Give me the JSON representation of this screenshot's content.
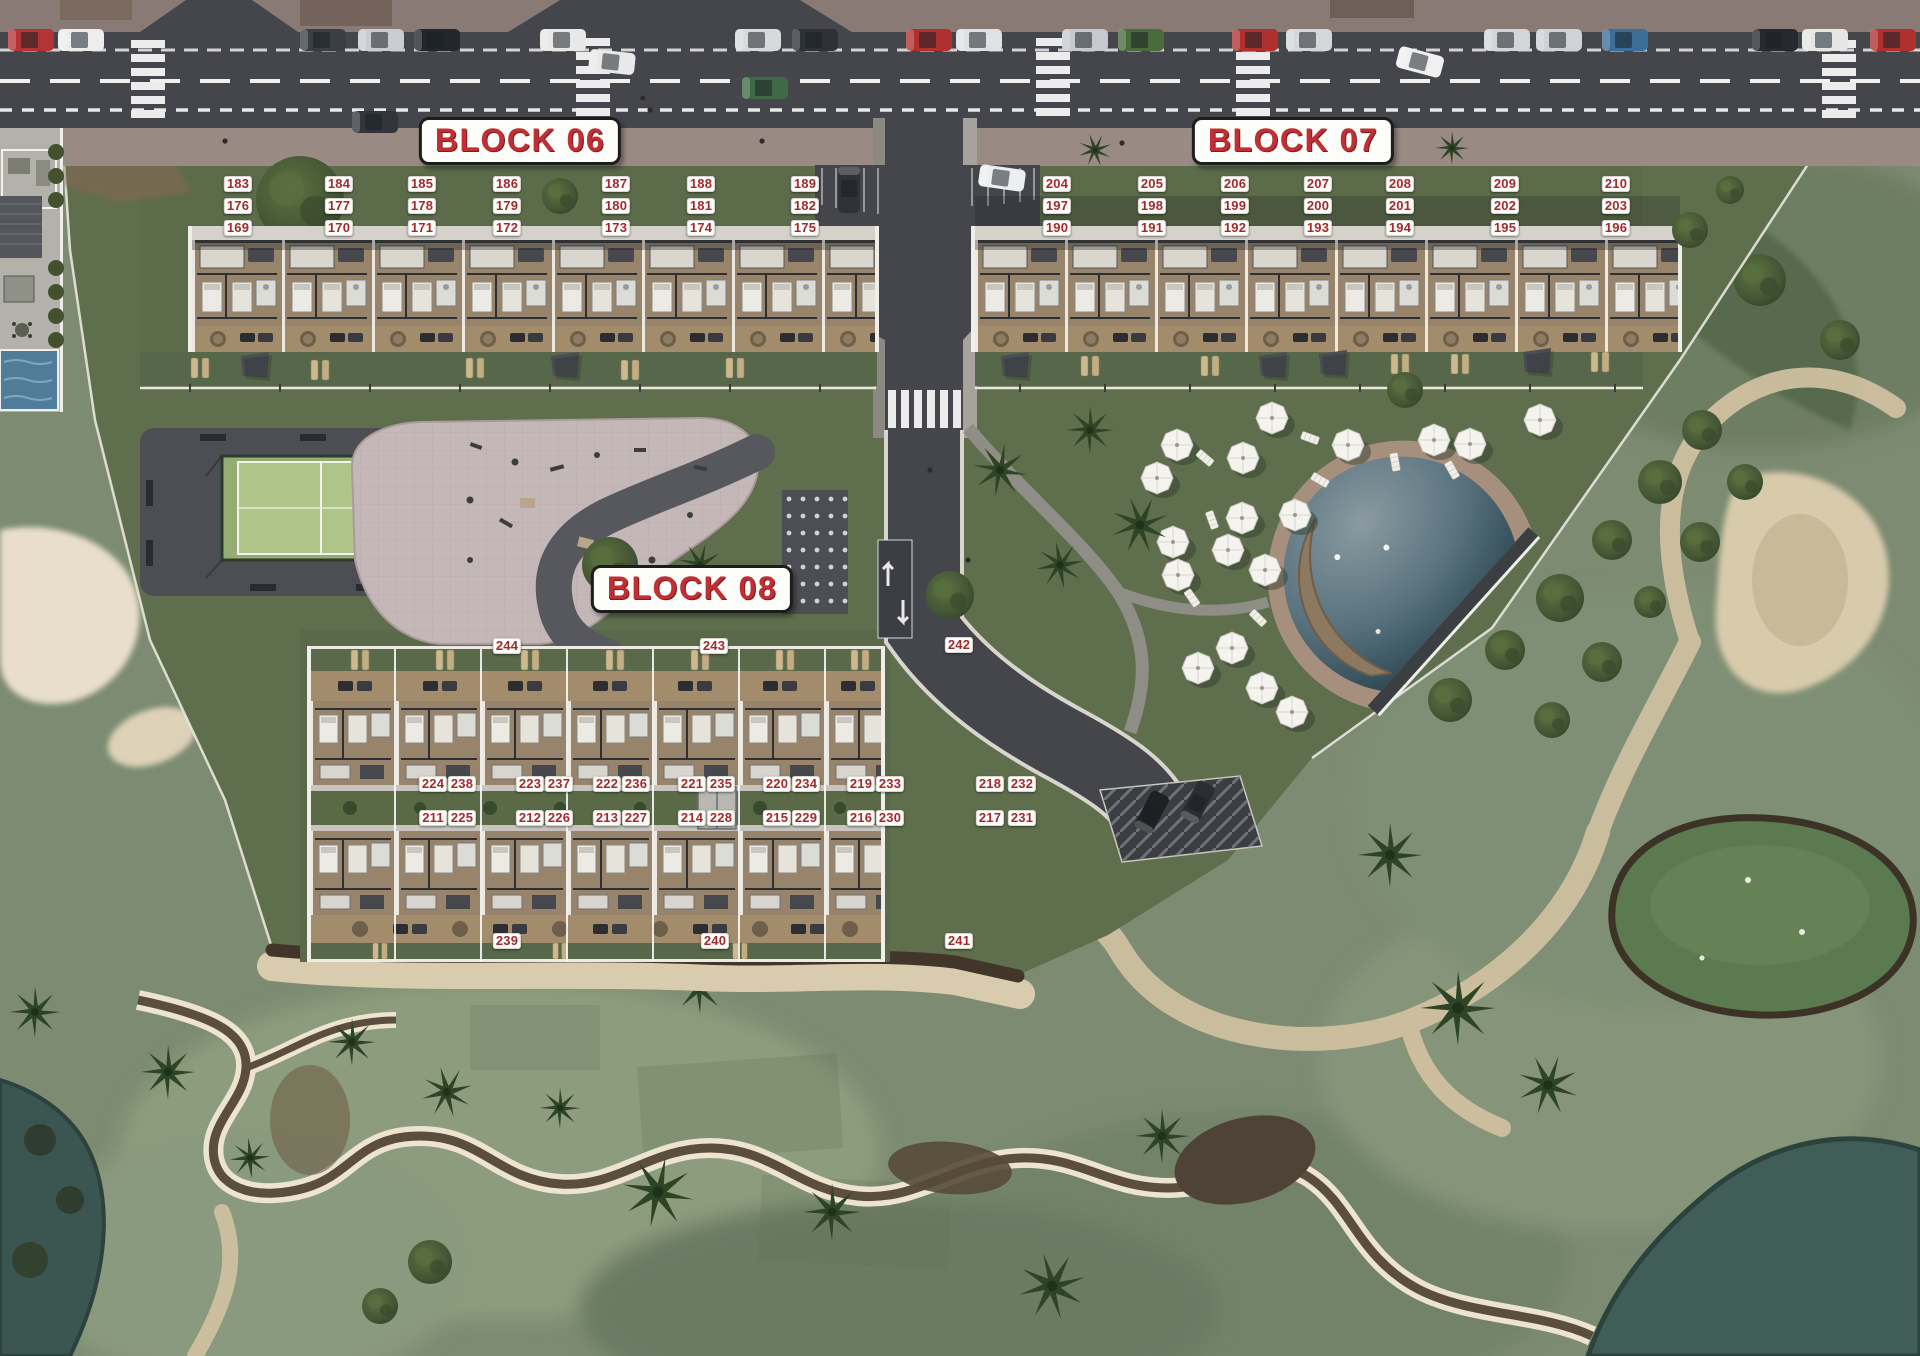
{
  "map": {
    "title_blocks": [
      {
        "id": "06",
        "label": "BLOCK 06",
        "x": 520,
        "y": 141
      },
      {
        "id": "07",
        "label": "BLOCK 07",
        "x": 1293,
        "y": 141
      },
      {
        "id": "08",
        "label": "BLOCK 08",
        "x": 692,
        "y": 589
      }
    ],
    "units": [
      {
        "n": "183",
        "x": 238,
        "y": 184
      },
      {
        "n": "184",
        "x": 339,
        "y": 184
      },
      {
        "n": "185",
        "x": 422,
        "y": 184
      },
      {
        "n": "186",
        "x": 507,
        "y": 184
      },
      {
        "n": "187",
        "x": 616,
        "y": 184
      },
      {
        "n": "188",
        "x": 701,
        "y": 184
      },
      {
        "n": "189",
        "x": 805,
        "y": 184
      },
      {
        "n": "176",
        "x": 238,
        "y": 206
      },
      {
        "n": "177",
        "x": 339,
        "y": 206
      },
      {
        "n": "178",
        "x": 422,
        "y": 206
      },
      {
        "n": "179",
        "x": 507,
        "y": 206
      },
      {
        "n": "180",
        "x": 616,
        "y": 206
      },
      {
        "n": "181",
        "x": 701,
        "y": 206
      },
      {
        "n": "182",
        "x": 805,
        "y": 206
      },
      {
        "n": "169",
        "x": 238,
        "y": 228
      },
      {
        "n": "170",
        "x": 339,
        "y": 228
      },
      {
        "n": "171",
        "x": 422,
        "y": 228
      },
      {
        "n": "172",
        "x": 507,
        "y": 228
      },
      {
        "n": "173",
        "x": 616,
        "y": 228
      },
      {
        "n": "174",
        "x": 701,
        "y": 228
      },
      {
        "n": "175",
        "x": 805,
        "y": 228
      },
      {
        "n": "204",
        "x": 1057,
        "y": 184
      },
      {
        "n": "205",
        "x": 1152,
        "y": 184
      },
      {
        "n": "206",
        "x": 1235,
        "y": 184
      },
      {
        "n": "207",
        "x": 1318,
        "y": 184
      },
      {
        "n": "208",
        "x": 1400,
        "y": 184
      },
      {
        "n": "209",
        "x": 1505,
        "y": 184
      },
      {
        "n": "210",
        "x": 1616,
        "y": 184
      },
      {
        "n": "197",
        "x": 1057,
        "y": 206
      },
      {
        "n": "198",
        "x": 1152,
        "y": 206
      },
      {
        "n": "199",
        "x": 1235,
        "y": 206
      },
      {
        "n": "200",
        "x": 1318,
        "y": 206
      },
      {
        "n": "201",
        "x": 1400,
        "y": 206
      },
      {
        "n": "202",
        "x": 1505,
        "y": 206
      },
      {
        "n": "203",
        "x": 1616,
        "y": 206
      },
      {
        "n": "190",
        "x": 1057,
        "y": 228
      },
      {
        "n": "191",
        "x": 1152,
        "y": 228
      },
      {
        "n": "192",
        "x": 1235,
        "y": 228
      },
      {
        "n": "193",
        "x": 1318,
        "y": 228
      },
      {
        "n": "194",
        "x": 1400,
        "y": 228
      },
      {
        "n": "195",
        "x": 1505,
        "y": 228
      },
      {
        "n": "196",
        "x": 1616,
        "y": 228
      },
      {
        "n": "244",
        "x": 507,
        "y": 646
      },
      {
        "n": "243",
        "x": 714,
        "y": 646
      },
      {
        "n": "242",
        "x": 959,
        "y": 645
      },
      {
        "n": "224",
        "x": 433,
        "y": 784
      },
      {
        "n": "238",
        "x": 462,
        "y": 784
      },
      {
        "n": "223",
        "x": 530,
        "y": 784
      },
      {
        "n": "237",
        "x": 559,
        "y": 784
      },
      {
        "n": "222",
        "x": 607,
        "y": 784
      },
      {
        "n": "236",
        "x": 636,
        "y": 784
      },
      {
        "n": "221",
        "x": 692,
        "y": 784
      },
      {
        "n": "235",
        "x": 721,
        "y": 784
      },
      {
        "n": "220",
        "x": 777,
        "y": 784
      },
      {
        "n": "234",
        "x": 806,
        "y": 784
      },
      {
        "n": "219",
        "x": 861,
        "y": 784
      },
      {
        "n": "233",
        "x": 890,
        "y": 784
      },
      {
        "n": "218",
        "x": 990,
        "y": 784
      },
      {
        "n": "232",
        "x": 1022,
        "y": 784
      },
      {
        "n": "211",
        "x": 433,
        "y": 818
      },
      {
        "n": "225",
        "x": 462,
        "y": 818
      },
      {
        "n": "212",
        "x": 530,
        "y": 818
      },
      {
        "n": "226",
        "x": 559,
        "y": 818
      },
      {
        "n": "213",
        "x": 607,
        "y": 818
      },
      {
        "n": "227",
        "x": 636,
        "y": 818
      },
      {
        "n": "214",
        "x": 692,
        "y": 818
      },
      {
        "n": "228",
        "x": 721,
        "y": 818
      },
      {
        "n": "215",
        "x": 777,
        "y": 818
      },
      {
        "n": "229",
        "x": 806,
        "y": 818
      },
      {
        "n": "216",
        "x": 861,
        "y": 818
      },
      {
        "n": "230",
        "x": 890,
        "y": 818
      },
      {
        "n": "217",
        "x": 990,
        "y": 818
      },
      {
        "n": "231",
        "x": 1022,
        "y": 818
      },
      {
        "n": "239",
        "x": 507,
        "y": 941
      },
      {
        "n": "240",
        "x": 715,
        "y": 941
      },
      {
        "n": "241",
        "x": 959,
        "y": 941
      }
    ]
  },
  "colors": {
    "badge_text": "#a32a2c",
    "label_text": "#bf2f34",
    "road": "#45464c",
    "site_green": "#5f6e4c",
    "pool_water": "#35525c",
    "sand": "#e6dcc3"
  }
}
